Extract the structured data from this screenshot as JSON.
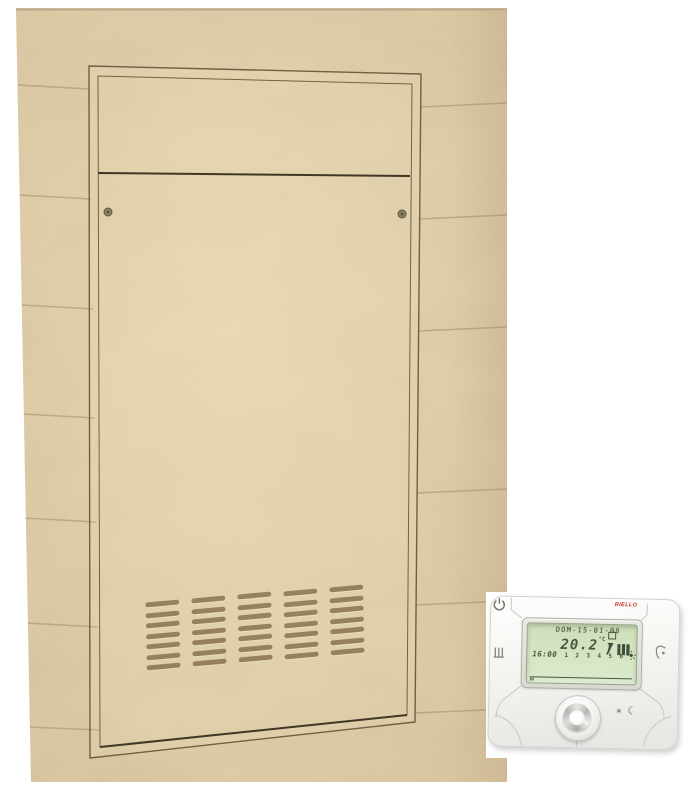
{
  "scene": {
    "background_color": "#ffffff"
  },
  "wall": {
    "base_color": "#dcc7a0",
    "seam_color": "#a08b64",
    "panel": {
      "frame_color": "#6f5f44",
      "door_edge_color": "#413727",
      "screw_color": "#8a8263",
      "screw_count": 2,
      "vent_columns": 5,
      "vent_slats_per_column": 7,
      "vent_color": "#7a623c"
    }
  },
  "thermostat": {
    "brand": "RIELLO",
    "brand_color": "#cc2a22",
    "body_color": "#f2f2ef",
    "lcd": {
      "bg_color": "#d3e3c1",
      "text_color": "#4b563f",
      "date": "DOM-15-01-06",
      "temperature": "20.2",
      "temp_unit": "°C",
      "time": "16:00",
      "day_numbers": [
        "1",
        "2",
        "3",
        "4",
        "5",
        "6"
      ],
      "hour_labels": [
        "0",
        "6",
        "12",
        "18",
        "24"
      ],
      "schedule": {
        "slots": 48,
        "on_ranges": [
          [
            10,
            17
          ],
          [
            30,
            39
          ]
        ]
      },
      "status_icons": [
        "program-box-icon",
        "flame-icon",
        "radiator-bars-icon",
        "auto-sun-icon"
      ]
    },
    "icons": {
      "sun_glyph": "☀",
      "moon_glyph": "☾"
    },
    "buttons": [
      "heating-button",
      "hot-water-button",
      "power-button",
      "rotary-knob",
      "day-night-button"
    ]
  }
}
